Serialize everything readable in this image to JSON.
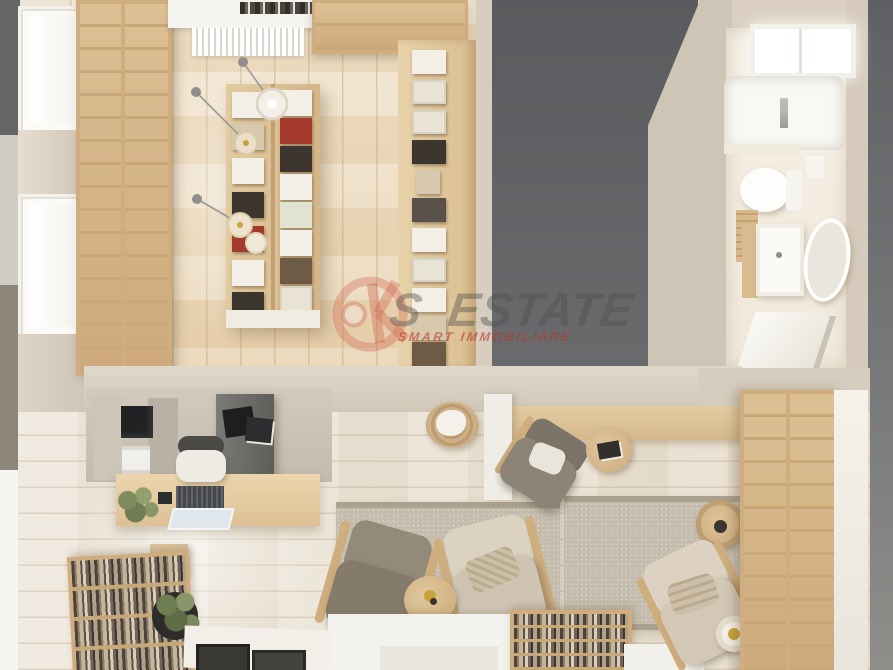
{
  "meta": {
    "type": "interior-3d-render",
    "view": "top-down",
    "subject": "studio apartment with home library, reading lounge and bathroom"
  },
  "watermark": {
    "logo": "k-circle-logo-icon",
    "prefix": "S",
    "text": "ESTATE",
    "tagline": "SMART IMMOBILIARE",
    "logo_color": "#c0503c",
    "text_color": "#4e4e4e",
    "tagline_color": "#ba3728"
  },
  "palette": {
    "dark_wall": "#5f6164",
    "beige_wall": "#cfc5b6",
    "upper_floor": "#ead9bd",
    "lower_floor": "#e9e1d5",
    "shelf_wood": "#d6ba8e",
    "white_fixture": "#f6f4ef",
    "rug": "#c7bfb0",
    "olive_chair": "#8a8173",
    "beige_chair": "#d6cbb9",
    "brass_accent": "#c9a43a"
  },
  "scene": {
    "rooms": [
      "library",
      "reading-lounge",
      "home-office-nook",
      "bathroom"
    ],
    "objects": [
      "wall-bookshelf-left",
      "wall-bookshelf-top",
      "island-bookshelf",
      "display-wall-books",
      "window-console-and-radiator",
      "pendant-lamps",
      "bathroom-skylight",
      "bathtub",
      "toilet",
      "vanity-sink",
      "oval-mirror",
      "desk-with-laptop",
      "office-chair",
      "storage-cabinet",
      "printer",
      "rug-left",
      "rug-right",
      "olive-armchair",
      "beige-armchair",
      "round-side-table",
      "floor-lamp",
      "white-coffee-table",
      "low-bookshelf",
      "wall-desk",
      "rattan-basket",
      "gray-armchair",
      "round-stool",
      "corner-beige-armchair",
      "right-wall-bookshelf",
      "bottom-left-bookshelf",
      "potted-plant",
      "picture-frames"
    ]
  }
}
